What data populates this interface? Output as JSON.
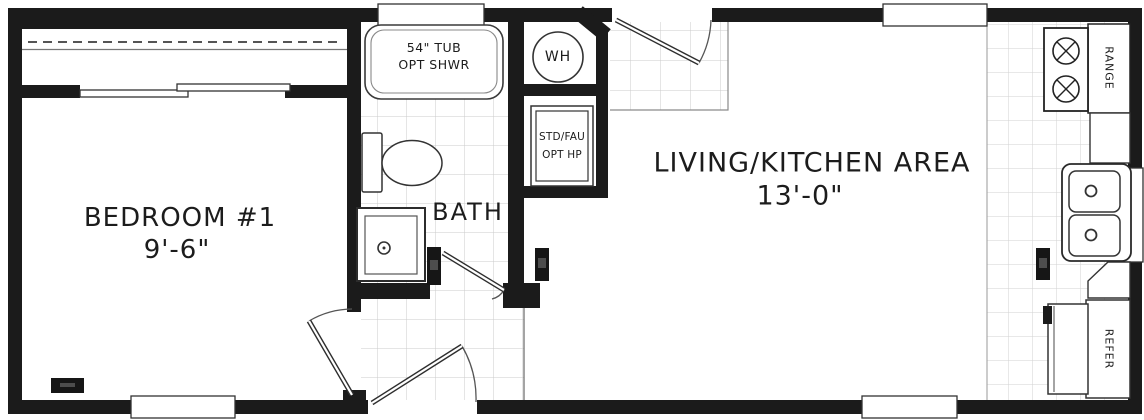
{
  "plan": {
    "bedroom": {
      "name": "BEDROOM #1",
      "dim": "9'-6\""
    },
    "bath": {
      "name": "BATH"
    },
    "living": {
      "name": "LIVING/KITCHEN AREA",
      "dim": "13'-0\""
    },
    "tub": {
      "line1": "54\" TUB",
      "line2": "OPT SHWR"
    },
    "water_heater": {
      "label": "WH"
    },
    "furnace": {
      "line1": "STD/FAU",
      "line2": "OPT HP"
    },
    "range": {
      "label": "RANGE"
    },
    "refrigerator": {
      "label": "REFER"
    }
  },
  "colors": {
    "wall": "#1b1b1b",
    "floor": "#ffffff",
    "tile_line": "#cbcbcb",
    "fixture_line": "#333333"
  }
}
